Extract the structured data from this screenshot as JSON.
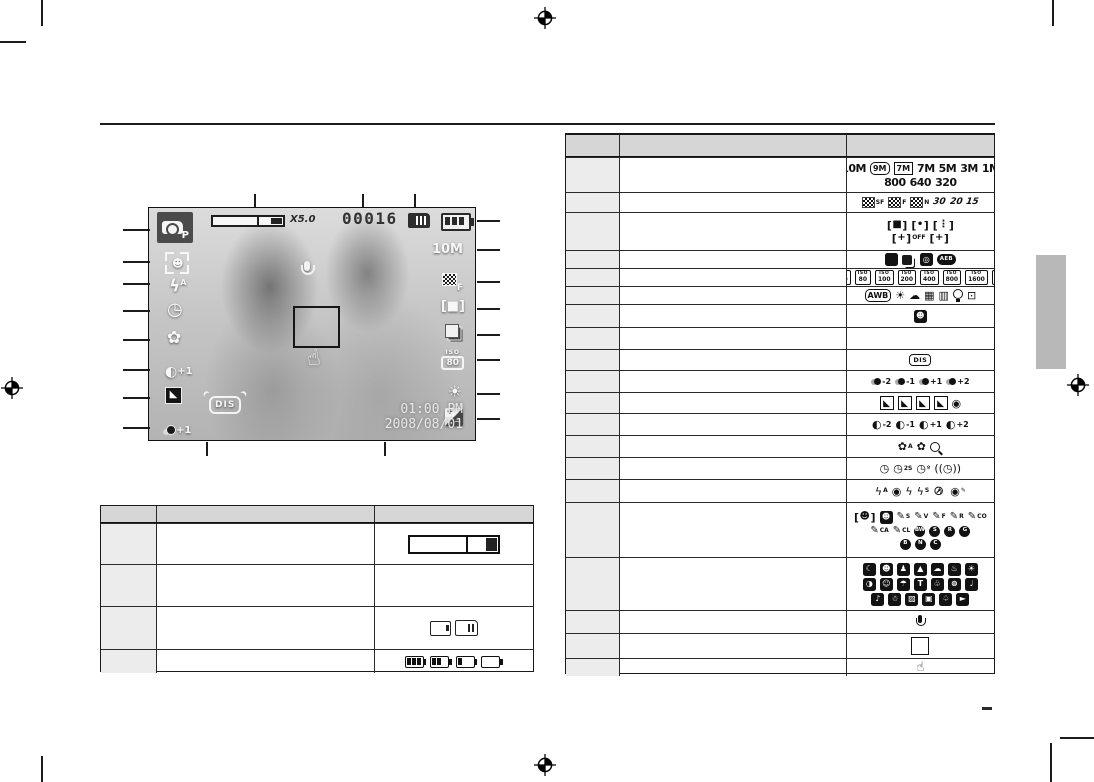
{
  "screen": {
    "mode_letter": "P",
    "zoom_rate": "X5.0",
    "shots_remaining": "00016",
    "image_size": "10M",
    "quality_letter": "F",
    "iso_label": "ISO",
    "iso_value": "80",
    "contrast_value": "+1",
    "saturation_value": "+1",
    "stabilizer_label": "DIS",
    "flash_mode_letter": "A",
    "time": "01:00 PM",
    "date": "2008/08/01",
    "ev_plus": "+",
    "ev_minus": "−"
  },
  "left_table": {
    "rows": [
      {
        "name": "optical-digital-zoom-bar",
        "lines": [
          [
            "lt-zoombar"
          ]
        ]
      },
      {
        "name": "available-shots",
        "lines": [
          []
        ]
      },
      {
        "name": "memory-card-indicator",
        "lines": [
          [
            "card-plain",
            "card-mmc"
          ]
        ]
      },
      {
        "name": "battery-indicator",
        "lines": [
          [
            "bat-3",
            "bat-2",
            "bat-1",
            "bat-0"
          ]
        ]
      }
    ]
  },
  "right_table": {
    "rows": [
      {
        "name": "image-size",
        "lines": [
          [
            "sz-10m",
            "sz-9mw",
            "sz-7mw",
            "sz-7m",
            "sz-5m",
            "sz-3m",
            "sz-1m"
          ],
          [
            "sz-800",
            "sz-640",
            "sz-320"
          ]
        ]
      },
      {
        "name": "quality-frame-rate",
        "lines": [
          [
            "q-sf",
            "q-f",
            "q-n",
            "fps-30",
            "fps-20",
            "fps-15"
          ]
        ]
      },
      {
        "name": "metering-af-area",
        "lines": [
          [
            "met-multi",
            "met-spot",
            "met-center"
          ],
          [
            "af-center-off",
            "af-center-on"
          ]
        ]
      },
      {
        "name": "drive-mode",
        "lines": [
          [
            "drv-single",
            "drv-continuous",
            "drv-motion",
            "drv-aeb"
          ]
        ]
      },
      {
        "name": "iso",
        "lines": [
          [
            "iso-auto",
            "iso-80",
            "iso-100",
            "iso-200",
            "iso-400",
            "iso-800",
            "iso-1600",
            "iso-3200"
          ]
        ]
      },
      {
        "name": "white-balance",
        "lines": [
          [
            "wb-auto",
            "wb-daylight",
            "wb-cloudy",
            "wb-fluorescent-h",
            "wb-fluorescent-l",
            "wb-tungsten",
            "wb-custom"
          ]
        ]
      },
      {
        "name": "face-detection-mark",
        "lines": [
          [
            "face-detection-mark"
          ]
        ]
      },
      {
        "name": "date-time",
        "lines": [
          []
        ]
      },
      {
        "name": "image-stabilizer",
        "lines": [
          [
            "dis-badge"
          ]
        ]
      },
      {
        "name": "saturation",
        "lines": [
          [
            "sat-minus2",
            "sat-minus1",
            "sat-plus1",
            "sat-plus2"
          ]
        ]
      },
      {
        "name": "sharpness",
        "lines": [
          [
            "sharp-soft2",
            "sharp-soft1",
            "sharp-vivid1",
            "sharp-vivid2",
            "acb"
          ]
        ]
      },
      {
        "name": "contrast",
        "lines": [
          [
            "con-minus2",
            "con-minus1",
            "con-plus1",
            "con-plus2"
          ]
        ]
      },
      {
        "name": "macro",
        "lines": [
          [
            "macro-auto",
            "macro",
            "macro-super"
          ]
        ]
      },
      {
        "name": "self-timer",
        "lines": [
          [
            "timer-10s",
            "timer-2s",
            "timer-double",
            "timer-motion"
          ]
        ]
      },
      {
        "name": "flash",
        "lines": [
          [
            "flash-auto",
            "flash-redeye",
            "flash-fill",
            "flash-slow",
            "flash-off",
            "flash-redeye-fix"
          ]
        ]
      },
      {
        "name": "photo-style-selector",
        "lines": [
          [
            "style-frame-normal",
            "style-frame-dark",
            "pen-soft",
            "pen-vivid",
            "pen-forest",
            "pen-retro",
            "pen-cool"
          ],
          [
            "pen-calm",
            "pen-classic",
            "color-bw",
            "color-sepia",
            "color-red",
            "color-green"
          ],
          [
            "color-blue",
            "color-negative",
            "color-custom"
          ]
        ]
      },
      {
        "name": "scene-mode",
        "lines": [
          [
            "scene-1",
            "scene-2",
            "scene-3",
            "scene-4",
            "scene-5",
            "scene-6",
            "scene-7"
          ],
          [
            "scene-8",
            "scene-9",
            "scene-10",
            "scene-11",
            "scene-12",
            "scene-13",
            "scene-14"
          ],
          [
            "scene-15",
            "scene-16",
            "scene-17",
            "scene-18",
            "scene-19",
            "scene-20"
          ]
        ]
      },
      {
        "name": "voice-memo",
        "lines": [
          [
            "voice-memo"
          ]
        ]
      },
      {
        "name": "autofocus-frame",
        "lines": [
          [
            "af-frame"
          ]
        ]
      },
      {
        "name": "camera-shake-warning",
        "lines": [
          [
            "shake-warning"
          ]
        ]
      }
    ]
  },
  "icons": {
    "lt-zoombar": {
      "k": "zoombar"
    },
    "card-plain": {
      "k": "card1"
    },
    "card-mmc": {
      "k": "card2"
    },
    "bat-3": {
      "k": "bat",
      "v": 3
    },
    "bat-2": {
      "k": "bat",
      "v": 2
    },
    "bat-1": {
      "k": "bat",
      "v": 1
    },
    "bat-0": {
      "k": "bat",
      "v": 0
    },
    "sz-10m": {
      "k": "t",
      "t": "10M"
    },
    "sz-9mw": {
      "k": "tb",
      "t": "9M",
      "r": 1
    },
    "sz-7mw": {
      "k": "tb",
      "t": "7M"
    },
    "sz-7m": {
      "k": "t",
      "t": "7M"
    },
    "sz-5m": {
      "k": "t",
      "t": "5M"
    },
    "sz-3m": {
      "k": "t",
      "t": "3M"
    },
    "sz-1m": {
      "k": "t",
      "t": "1M"
    },
    "sz-800": {
      "k": "t",
      "t": "800"
    },
    "sz-640": {
      "k": "t",
      "t": "640"
    },
    "sz-320": {
      "k": "t",
      "t": "320"
    },
    "q-sf": {
      "k": "chk",
      "s": "SF"
    },
    "q-f": {
      "k": "chk",
      "s": "F"
    },
    "q-n": {
      "k": "chk",
      "s": "N"
    },
    "fps-30": {
      "k": "fps",
      "t": "30"
    },
    "fps-20": {
      "k": "fps",
      "t": "20"
    },
    "fps-15": {
      "k": "fps",
      "t": "15"
    },
    "met-multi": {
      "k": "brk",
      "t": "■"
    },
    "met-spot": {
      "k": "brk",
      "t": "•"
    },
    "met-center": {
      "k": "brk",
      "t": "⋮"
    },
    "af-center-off": {
      "k": "brk",
      "t": "+",
      "s": "OFF"
    },
    "af-center-on": {
      "k": "brk",
      "t": "+"
    },
    "drv-single": {
      "k": "sq",
      "t": ""
    },
    "drv-continuous": {
      "k": "stack"
    },
    "drv-motion": {
      "k": "sq",
      "t": "◎"
    },
    "drv-aeb": {
      "k": "dark",
      "t": "AEB"
    },
    "iso-auto": {
      "k": "iso",
      "l": "ISO",
      "t": "AUTO"
    },
    "iso-80": {
      "k": "iso",
      "l": "ISO",
      "t": "80"
    },
    "iso-100": {
      "k": "iso",
      "l": "ISO",
      "t": "100"
    },
    "iso-200": {
      "k": "iso",
      "l": "ISO",
      "t": "200"
    },
    "iso-400": {
      "k": "iso",
      "l": "ISO",
      "t": "400"
    },
    "iso-800": {
      "k": "iso",
      "l": "ISO",
      "t": "800"
    },
    "iso-1600": {
      "k": "iso",
      "l": "ISO",
      "t": "1600"
    },
    "iso-3200": {
      "k": "iso",
      "l": "ISO",
      "t": "3200"
    },
    "wb-auto": {
      "k": "tb",
      "t": "AWB",
      "r": 1
    },
    "wb-daylight": {
      "k": "g",
      "t": "☀"
    },
    "wb-cloudy": {
      "k": "g",
      "t": "☁"
    },
    "wb-fluorescent-h": {
      "k": "g",
      "t": "▦"
    },
    "wb-fluorescent-l": {
      "k": "g",
      "t": "▥"
    },
    "wb-tungsten": {
      "k": "bulb"
    },
    "wb-custom": {
      "k": "g",
      "t": "⊡"
    },
    "face-detection-mark": {
      "k": "sq",
      "t": "☻"
    },
    "dis-badge": {
      "k": "dis",
      "t": "DIS"
    },
    "sat-minus2": {
      "k": "sat",
      "t": "-2"
    },
    "sat-minus1": {
      "k": "sat",
      "t": "-1"
    },
    "sat-plus1": {
      "k": "sat",
      "t": "+1"
    },
    "sat-plus2": {
      "k": "sat",
      "t": "+2"
    },
    "sharp-soft2": {
      "k": "shp"
    },
    "sharp-soft1": {
      "k": "shp"
    },
    "sharp-vivid1": {
      "k": "shp"
    },
    "sharp-vivid2": {
      "k": "shp"
    },
    "acb": {
      "k": "g",
      "t": "◉"
    },
    "con-minus2": {
      "k": "con",
      "t": "-2"
    },
    "con-minus1": {
      "k": "con",
      "t": "-1"
    },
    "con-plus1": {
      "k": "con",
      "t": "+1"
    },
    "con-plus2": {
      "k": "con",
      "t": "+2"
    },
    "macro-auto": {
      "k": "g",
      "t": "✿",
      "s": "A"
    },
    "macro": {
      "k": "g",
      "t": "✿"
    },
    "macro-super": {
      "k": "mag"
    },
    "timer-10s": {
      "k": "g",
      "t": "◷"
    },
    "timer-2s": {
      "k": "g",
      "t": "◷",
      "p": "2S"
    },
    "timer-double": {
      "k": "g",
      "t": "◷",
      "p": "º"
    },
    "timer-motion": {
      "k": "g",
      "t": "((◷))"
    },
    "flash-auto": {
      "k": "g",
      "t": "ϟ",
      "p": "A"
    },
    "flash-redeye": {
      "k": "g",
      "t": "◉"
    },
    "flash-fill": {
      "k": "g",
      "t": "ϟ"
    },
    "flash-slow": {
      "k": "g",
      "t": "ϟ",
      "s": "S"
    },
    "flash-off": {
      "k": "floff",
      "t": "ϟ"
    },
    "flash-redeye-fix": {
      "k": "g",
      "t": "◉",
      "p": "✎"
    },
    "style-frame-normal": {
      "k": "brk",
      "t": "☻"
    },
    "style-frame-dark": {
      "k": "sq",
      "t": "☻"
    },
    "pen-soft": {
      "k": "pen",
      "t": "✎",
      "s": "S"
    },
    "pen-vivid": {
      "k": "pen",
      "t": "✎",
      "s": "V"
    },
    "pen-forest": {
      "k": "pen",
      "t": "✎",
      "s": "F"
    },
    "pen-retro": {
      "k": "pen",
      "t": "✎",
      "s": "R"
    },
    "pen-cool": {
      "k": "pen",
      "t": "✎",
      "s": "CO"
    },
    "pen-calm": {
      "k": "pen",
      "t": "✎",
      "s": "CA"
    },
    "pen-classic": {
      "k": "pen",
      "t": "✎",
      "s": "CL"
    },
    "color-bw": {
      "k": "cb",
      "t": "BW"
    },
    "color-sepia": {
      "k": "cb",
      "t": "S"
    },
    "color-red": {
      "k": "cb",
      "t": "R"
    },
    "color-green": {
      "k": "cb",
      "t": "G"
    },
    "color-blue": {
      "k": "cb",
      "t": "B"
    },
    "color-negative": {
      "k": "cb",
      "t": "N"
    },
    "color-custom": {
      "k": "cb",
      "t": "C"
    },
    "scene-1": {
      "k": "sq",
      "t": "☾"
    },
    "scene-2": {
      "k": "sq",
      "t": "☻"
    },
    "scene-3": {
      "k": "sq",
      "t": "♟"
    },
    "scene-4": {
      "k": "sq",
      "t": "▲"
    },
    "scene-5": {
      "k": "sq",
      "t": "☁"
    },
    "scene-6": {
      "k": "sq",
      "t": "♨"
    },
    "scene-7": {
      "k": "sq",
      "t": "☀"
    },
    "scene-8": {
      "k": "sq",
      "t": "◑"
    },
    "scene-9": {
      "k": "sq",
      "t": "☺"
    },
    "scene-10": {
      "k": "sq",
      "t": "☂"
    },
    "scene-11": {
      "k": "sq",
      "t": "T"
    },
    "scene-12": {
      "k": "sq",
      "t": "♧"
    },
    "scene-13": {
      "k": "sq",
      "t": "⊜"
    },
    "scene-14": {
      "k": "sq",
      "t": "♩"
    },
    "scene-15": {
      "k": "sq",
      "t": "♪"
    },
    "scene-16": {
      "k": "sq",
      "t": "☃"
    },
    "scene-17": {
      "k": "sq",
      "t": "▨"
    },
    "scene-18": {
      "k": "sq",
      "t": "▣"
    },
    "scene-19": {
      "k": "sq",
      "t": "♤"
    },
    "scene-20": {
      "k": "sq",
      "t": "►"
    },
    "voice-memo": {
      "k": "mic"
    },
    "af-frame": {
      "k": "afbox"
    },
    "shake-warning": {
      "k": "hand",
      "t": "☝"
    }
  }
}
